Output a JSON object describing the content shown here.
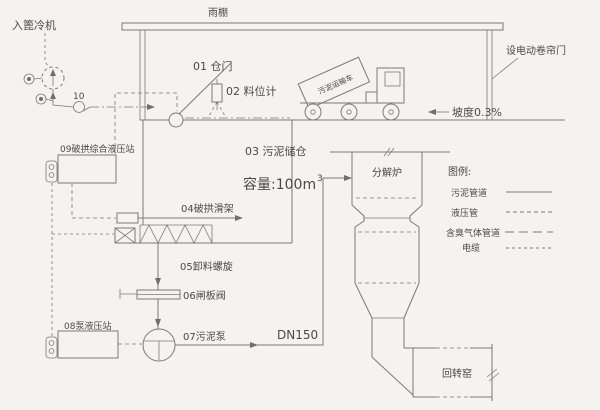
{
  "meta": {
    "colors": {
      "background": "#f4f3f0",
      "line": "#7a7a7a",
      "text": "#4a4a4a"
    },
    "drawing_type": "sludge-silo-feeding-system-schematic"
  },
  "labels": {
    "cooler": "入篦冷机",
    "canopy": "雨棚",
    "door": "01 仓门",
    "level_gauge": "02 料位计",
    "truck": "污泥运输车",
    "rolling_door": "设电动卷帘门",
    "slope": "坡度0.3%",
    "silo_title": "03 污泥储仓",
    "silo_capacity_prefix": "容量:100m",
    "silo_capacity_sup": "3",
    "arch_breaker": "04破拱滑架",
    "discharge_screw": "05卸料螺旋",
    "gate_valve": "06闸板阀",
    "sludge_pump": "07污泥泵",
    "pump_hydraulic": "08泵液压站",
    "main_hydraulic": "09破拱综合液压站",
    "fan_no": "10",
    "pipe_dn": "DN150",
    "calciner": "分解炉",
    "rotary_kiln": "回转窑"
  },
  "legend": {
    "title": "图例:",
    "items": [
      {
        "label": "污泥管道",
        "style": "solid"
      },
      {
        "label": "液压管",
        "style": "dashed"
      },
      {
        "label": "含臭气体管道",
        "style": "long-dash"
      },
      {
        "label": "电缆",
        "style": "fine-dash"
      }
    ]
  }
}
